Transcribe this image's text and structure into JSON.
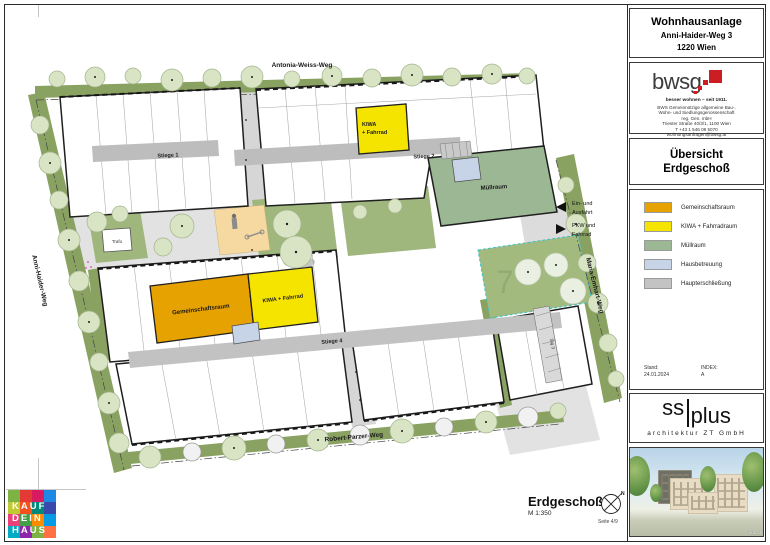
{
  "sheet": {
    "project": {
      "name": "Wohnhausanlage",
      "address": "Anni-Haider-Weg 3",
      "city": "1220 Wien"
    },
    "bwsg": {
      "wordmark": "bwsg",
      "tagline": "besser wohnen – seit 1911.",
      "accent_color": "#cc1d24",
      "info_lines": [
        "BWS Gemeinnützige allgemeine Bau-,",
        "Wohn- und Siedlungsgenossenschaft",
        "reg. Gen. mbH",
        "Triester Straße 40/3/1, 1100 Wien",
        "T +43 1 546 08 5070",
        "wohnungsanfragen@bwsg.at"
      ]
    },
    "sheet_title": {
      "line1": "Übersicht",
      "line2": "Erdgeschoß"
    },
    "legend": {
      "items": [
        {
          "label": "Gemeinschaftsraum",
          "color": "#e6a200"
        },
        {
          "label": "KIWA + Fahrradraum",
          "color": "#f5e400"
        },
        {
          "label": "Müllraum",
          "color": "#9cb794"
        },
        {
          "label": "Hausbetreuung",
          "color": "#c7d4e8"
        },
        {
          "label": "Haupterschließung",
          "color": "#c3c3c3"
        }
      ]
    },
    "revision": {
      "stand_label": "Stand:",
      "stand_value": "24.01.2024",
      "index_label": "INDEX:",
      "index_value": "A"
    },
    "architect": {
      "logo_left": "ss",
      "logo_right": "plus",
      "subtitle": "architektur ZT GmbH"
    },
    "rendering": {
      "credit": "© vdx.at"
    }
  },
  "plan": {
    "streets": {
      "top": "Antonia-Weiss-Weg",
      "left": "Anni-Haider-Weg",
      "right": "Maria-Emhart-Weg",
      "bottom": "Robert-Parzer-Weg"
    },
    "rooms": {
      "gemeinschaftsraum": "Gemeinschaftsraum",
      "kiwa_line1": "KIWA",
      "kiwa_line2": "+ Fahrrad",
      "kiwa_mid": "KIWA + Fahrrad",
      "muellraum": "Müllraum",
      "trafo": "Trafo"
    },
    "stiegen": {
      "s1": "Stiege 1",
      "s2": "Stiege 2",
      "s3": "Stg 3",
      "s4": "Stiege 4"
    },
    "plot_number": "7",
    "entrance_note": [
      "Ein- und",
      "Ausfahrt",
      "PKW und",
      "Fahrrad"
    ],
    "caption": {
      "title": "Erdgeschoß",
      "scale": "M 1:350",
      "north": "N",
      "page": "Seite  4/9"
    },
    "colors": {
      "street_green": "#8aa261",
      "courtyard_green": "#9fb67c",
      "tree_green": "#d8e4c4",
      "plaza_gray": "#e2e2e2",
      "corridor_gray": "#bdbdbd",
      "orange": "#e6a200",
      "yellow": "#f5e400",
      "sage": "#9cb794",
      "blue": "#c7d4e8",
      "sand": "#f6d9a0"
    }
  },
  "brand_footer": {
    "lines": [
      "KAUF",
      "DEIN",
      "HAUS"
    ]
  }
}
